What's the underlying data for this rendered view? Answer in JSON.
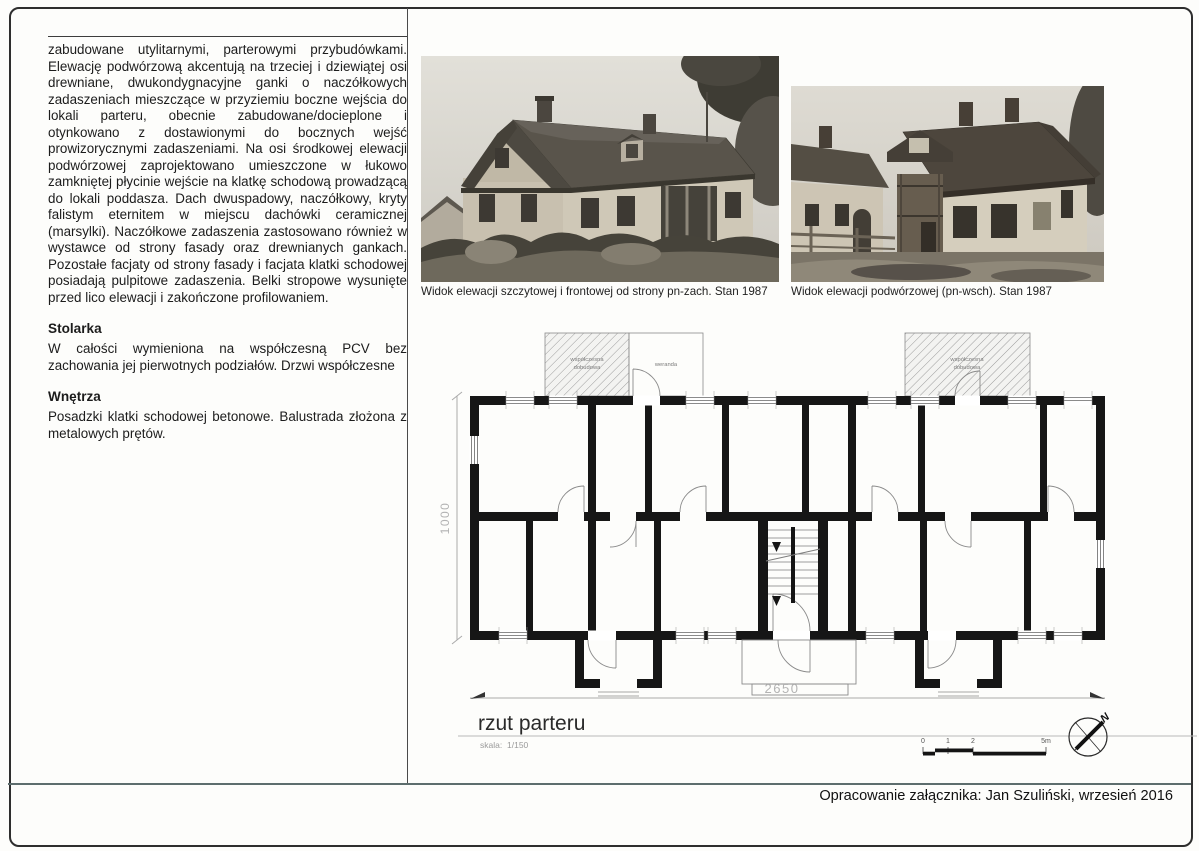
{
  "page": {
    "footer": "Opracowanie załącznika: Jan Szuliński, wrzesień 2016"
  },
  "left_column": {
    "intro": "zabudowane utylitarnymi, parterowymi przybudówkami. Elewację podwórzową akcentują na trzeciej i dziewiątej osi drewniane, dwukondygnacyjne ganki o naczółkowych zadaszeniach mieszczące w przyziemiu boczne wejścia do lokali parteru, obecnie zabudowane/docieplone i otynkowano z dostawionymi do bocznych wejść prowizorycznymi zadaszeniami. Na osi środkowej elewacji podwórzowej zaprojektowano umieszczone w łukowo zamkniętej płycinie wejście na klatkę schodową prowadzącą do lokali poddasza. Dach dwuspadowy, naczółkowy, kryty falistym eternitem w miejscu dachówki ceramicznej (marsylki). Naczółkowe zadaszenia zastosowano również w wystawce od strony fasady oraz drewnianych gankach. Pozostałe facjaty od strony fasady i facjata klatki schodowej posiadają pulpitowe zadaszenia. Belki stropowe wysunięte przed lico elewacji i zakończone profilowaniem.",
    "sections": [
      {
        "heading": "Stolarka",
        "body": "W całości wymieniona na współczesną PCV bez zachowania jej pierwotnych podziałów. Drzwi współczesne"
      },
      {
        "heading": "Wnętrza",
        "body": "Posadzki klatki schodowej betonowe. Balustrada złożona z metalowych prętów."
      }
    ]
  },
  "photos": [
    {
      "caption": "Widok elewacji szczytowej i frontowej od strony pn-zach. Stan 1987"
    },
    {
      "caption": "Widok  elewacji podwórzowej (pn-wsch). Stan 1987"
    }
  ],
  "plan": {
    "title": "rzut parteru",
    "scale_label": "skala:",
    "scale_value": "1/150",
    "dim_vertical": "1000",
    "dim_horizontal": "2650",
    "addition_line1": "współczesna",
    "addition_line2": "dobudowa",
    "veranda_label": "weranda",
    "scalebar_ticks": [
      "0",
      "1",
      "2",
      "5m"
    ],
    "compass_label": "N"
  }
}
